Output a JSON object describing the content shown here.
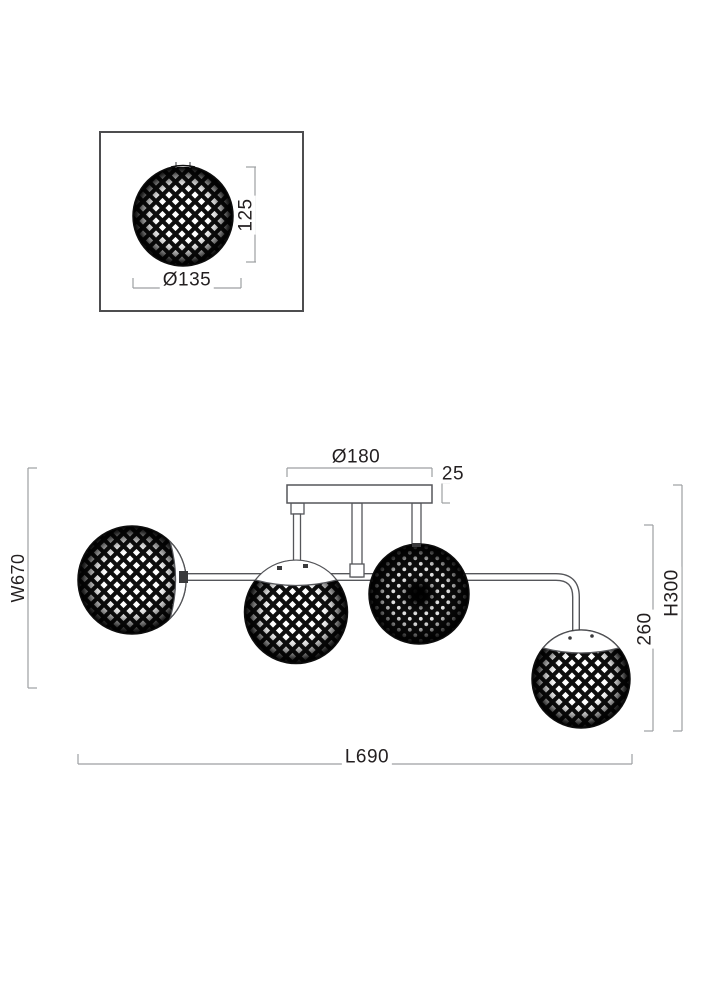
{
  "drawing": {
    "type": "technical-dimension-drawing",
    "subject": "4-light ceiling lamp with lattice sphere shades",
    "detail_view": {
      "diameter_label": "Ø135",
      "height_label": "125"
    },
    "main_view": {
      "canopy_diameter_label": "Ø180",
      "canopy_thickness_label": "25",
      "width_label": "W670",
      "shade_drop_label": "260",
      "height_label": "H300",
      "length_label": "L690"
    },
    "colors": {
      "outline": "#55565a",
      "dimension_line": "#9d9fa2",
      "text": "#231f20",
      "shade_fill": "#0e0e0e",
      "background": "#ffffff"
    }
  }
}
